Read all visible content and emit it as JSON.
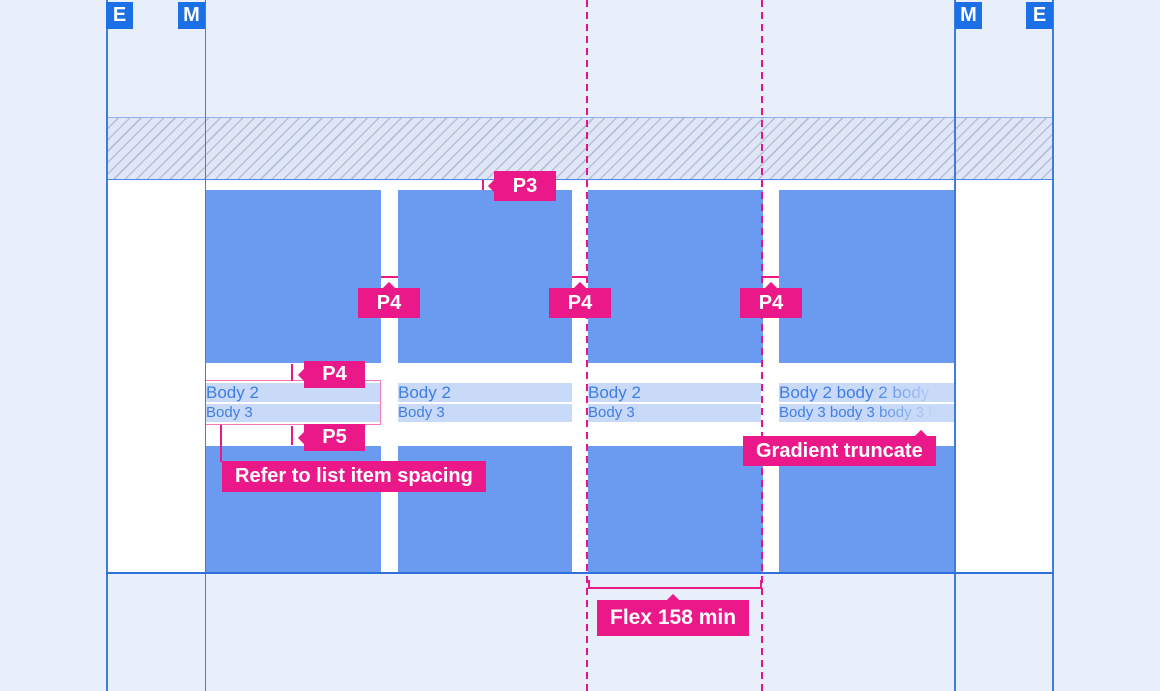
{
  "margin_badges": [
    {
      "label": "E"
    },
    {
      "label": "M"
    },
    {
      "label": "M"
    },
    {
      "label": "E"
    }
  ],
  "annotations": {
    "p3": "P3",
    "p4": "P4",
    "p5": "P5",
    "refer": "Refer to list item spacing",
    "gradient_truncate": "Gradient truncate",
    "flex": "Flex 158 min"
  },
  "cards": [
    {
      "body2": "Body 2",
      "body3": "Body 3"
    },
    {
      "body2": "Body 2",
      "body3": "Body 3"
    },
    {
      "body2": "Body 2",
      "body3": "Body 3"
    },
    {
      "body2": "Body 2 body 2 body 2 body",
      "body3": "Body 3 body 3 body 3 body 3",
      "truncated": true
    }
  ],
  "colors": {
    "canvas_bg": "#E8EEFA",
    "accent_pink": "#EA1889",
    "outline_pink": "#F478B8",
    "card_blue": "#6B9BF0",
    "marker_blue": "#1B70E8",
    "guide_blue": "#3F7CE2",
    "row_highlight": "#C9DAF8",
    "body_text_blue": "#3E7DE7"
  }
}
